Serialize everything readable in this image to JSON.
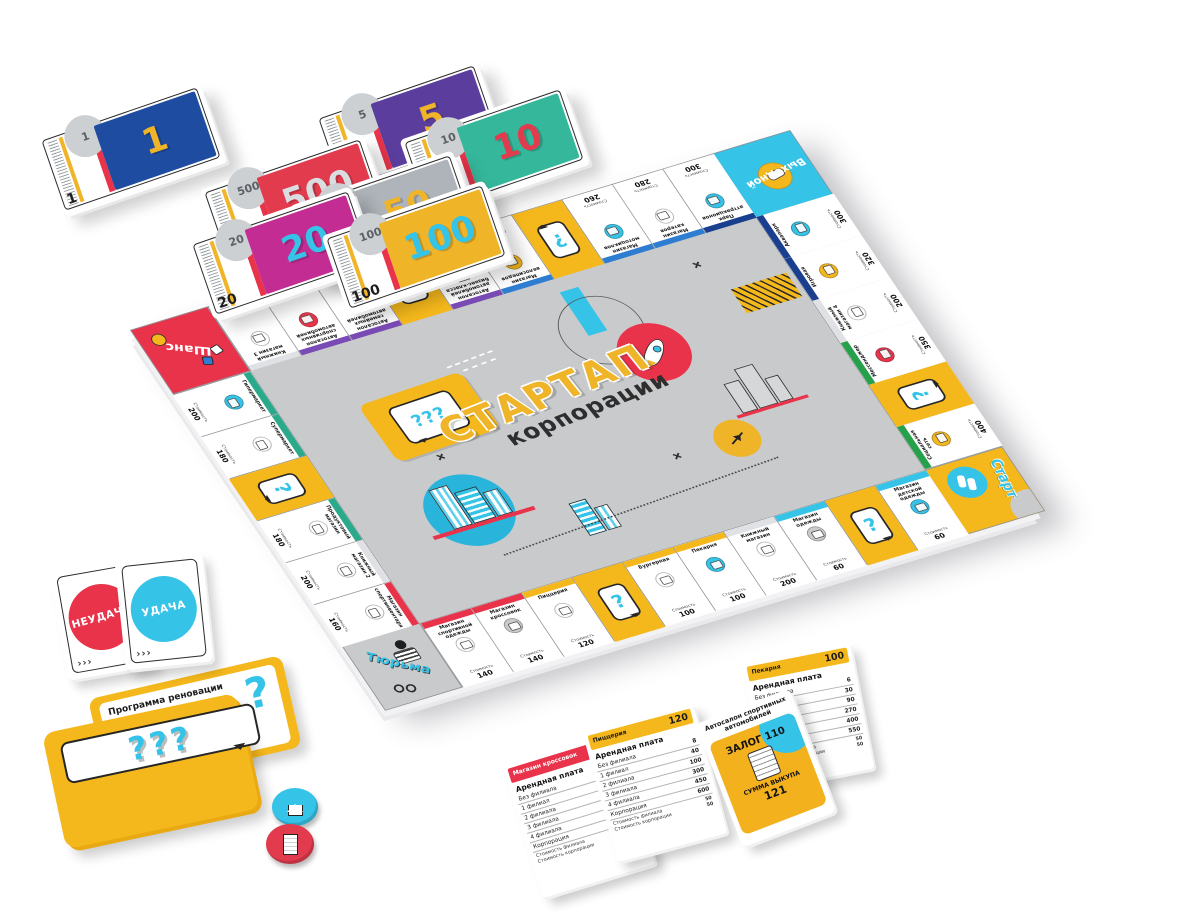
{
  "center": {
    "title_top": "СТАРТАП",
    "title_bottom": "корпорации"
  },
  "cost_label": "Стоимость",
  "question_mark": "?",
  "deco": {
    "q3": "???",
    "chevrons": "›››"
  },
  "colors": {
    "accent_yellow": "#f5b81c",
    "accent_cyan": "#35c3e8",
    "accent_red": "#e8334a",
    "board_gray": "#c9cacc",
    "group_purple": "#7a4bb5",
    "group_blue": "#2e7dd1",
    "group_darkblue": "#1b3f8f",
    "group_green": "#27a04b",
    "group_teal": "#2aa98b"
  },
  "board": {
    "corners": {
      "chance": "Шанс",
      "dayoff": "Выходной",
      "start": "Старт",
      "jail": "Тюрьма"
    },
    "top": [
      {
        "name": "Книжный магазин 3",
        "price": "200",
        "group": "#dfe1e4",
        "icon_color": "#ffffff"
      },
      {
        "name": "Автосалон спортивных автомобилей",
        "price": "220",
        "group": "#7a4bb5",
        "icon_color": "#e8334a"
      },
      {
        "name": "Автосалон семейных автомобилей",
        "price": "220",
        "group": "#7a4bb5",
        "icon_color": "#35c3e8"
      },
      {
        "type": "question"
      },
      {
        "name": "Автосалон автомобилей бизнес-класса",
        "price": "240",
        "group": "#7a4bb5",
        "icon_color": "#c9cacc",
        "badge": "VIP"
      },
      {
        "name": "Магазин велосипедов",
        "price": "260",
        "group": "#2e7dd1",
        "icon_color": "#f5b81c"
      },
      {
        "type": "question"
      },
      {
        "name": "Магазин мотоциклов",
        "price": "260",
        "group": "#2e7dd1",
        "icon_color": "#35c3e8"
      },
      {
        "name": "Магазин катеров",
        "price": "280",
        "group": "#2e7dd1",
        "icon_color": "#ffffff"
      },
      {
        "name": "Парк аттракционов",
        "price": "300",
        "group": "#1b3f8f",
        "icon_color": "#35c3e8"
      }
    ],
    "right": [
      {
        "name": "Аквапарк",
        "price": "300",
        "group": "#1b3f8f",
        "icon_color": "#35c3e8"
      },
      {
        "name": "Игровая",
        "price": "320",
        "group": "#1b3f8f",
        "icon_color": "#f5b81c"
      },
      {
        "name": "Книжный магазин 4",
        "price": "200",
        "group": "#dfe1e4",
        "icon_color": "#ffffff"
      },
      {
        "name": "Мессенджер",
        "price": "350",
        "group": "#27a04b",
        "icon_color": "#e8334a"
      },
      {
        "type": "question"
      },
      {
        "name": "Социальная сеть",
        "price": "400",
        "group": "#27a04b",
        "icon_color": "#f5b81c"
      }
    ],
    "bottom": [
      {
        "name": "Магазин спортивной одежды",
        "price": "140",
        "group": "#e8334a",
        "icon_color": "#ffffff"
      },
      {
        "name": "Магазин кроссовок",
        "price": "140",
        "group": "#e8334a",
        "icon_color": "#c9cacc"
      },
      {
        "name": "Пиццерия",
        "price": "120",
        "group": "#f5b81c",
        "icon_color": "#ffffff"
      },
      {
        "type": "question"
      },
      {
        "name": "Бургерная",
        "price": "100",
        "group": "#f5b81c",
        "icon_color": "#ffffff"
      },
      {
        "name": "Пекарня",
        "price": "100",
        "group": "#f5b81c",
        "icon_color": "#35c3e8"
      },
      {
        "name": "Книжный магазин",
        "price": "200",
        "group": "#dfe1e4",
        "icon_color": "#ffffff"
      },
      {
        "name": "Магазин одежды",
        "price": "60",
        "group": "#35c3e8",
        "icon_color": "#c9cacc"
      },
      {
        "type": "question"
      },
      {
        "name": "Магазин детской одежды",
        "price": "60",
        "group": "#35c3e8",
        "icon_color": "#35c3e8"
      }
    ],
    "left": [
      {
        "name": "Гипермаркет",
        "price": "200",
        "group": "#2aa98b",
        "icon_color": "#35c3e8"
      },
      {
        "name": "Супермаркет",
        "price": "180",
        "group": "#2aa98b",
        "icon_color": "#ffffff"
      },
      {
        "type": "question"
      },
      {
        "name": "Продуктовый магазин",
        "price": "180",
        "group": "#2aa98b",
        "icon_color": "#ffffff"
      },
      {
        "name": "Книжный магазин 2",
        "price": "200",
        "group": "#dfe1e4",
        "icon_color": "#ffffff"
      },
      {
        "name": "Магазин спортинвентаря",
        "price": "160",
        "group": "#e8334a",
        "icon_color": "#ffffff"
      }
    ]
  },
  "money": [
    {
      "value": "1",
      "color": "#1e4ca0",
      "num_color": "#f0b429"
    },
    {
      "value": "5",
      "color": "#5b3d9e",
      "num_color": "#f0b429"
    },
    {
      "value": "10",
      "color": "#35b79b",
      "num_color": "#e23b4e"
    },
    {
      "value": "20",
      "color": "#c22c93",
      "num_color": "#35c3e8"
    },
    {
      "value": "50",
      "color": "#aeb4b9",
      "num_color": "#f0b429"
    },
    {
      "value": "100",
      "color": "#f0b429",
      "num_color": "#35c3e8"
    },
    {
      "value": "500",
      "color": "#e23b4e",
      "num_color": "#d9dde0"
    }
  ],
  "cards": {
    "fail_label": "НЕУДАЧА",
    "luck_label": "УДАЧА",
    "fail_color": "#e8334a",
    "luck_color": "#35c3e8",
    "renovation_title": "Программа реновации",
    "rent_label": "Арендная плата",
    "property_cards": [
      {
        "name": "Магазин кроссовок",
        "price": "140",
        "header_color": "#e8334a",
        "header_text": "#ffffff",
        "rows": [
          [
            "Без филиала",
            "10"
          ],
          [
            "1 филиал",
            "50"
          ],
          [
            "2 филиала",
            "150"
          ],
          [
            "3 филиала",
            "450"
          ],
          [
            "4 филиала",
            "625"
          ],
          [
            "Корпорация",
            "750"
          ]
        ],
        "branch_cost_label": "Стоимость филиала",
        "branch_cost": "100",
        "corp_cost_label": "Стоимость корпорации",
        "corp_cost": "100"
      },
      {
        "name": "Пиццерия",
        "price": "120",
        "header_color": "#f5b81c",
        "header_text": "#1c1c1c",
        "rows": [
          [
            "Без филиала",
            "8"
          ],
          [
            "1 филиал",
            "40"
          ],
          [
            "2 филиала",
            "100"
          ],
          [
            "3 филиала",
            "300"
          ],
          [
            "4 филиала",
            "450"
          ],
          [
            "Корпорация",
            "600"
          ]
        ],
        "branch_cost_label": "Стоимость филиала",
        "branch_cost": "50",
        "corp_cost_label": "Стоимость корпорации",
        "corp_cost": "50"
      },
      {
        "name": "Пекарня",
        "price": "100",
        "header_color": "#f5b81c",
        "header_text": "#1c1c1c",
        "rows": [
          [
            "Без филиала",
            "6"
          ],
          [
            "1 филиал",
            "30"
          ],
          [
            "2 филиала",
            "90"
          ],
          [
            "3 филиала",
            "270"
          ],
          [
            "4 филиала",
            "400"
          ],
          [
            "Корпорация",
            "550"
          ]
        ],
        "branch_cost_label": "Стоимость филиала",
        "branch_cost": "50",
        "corp_cost_label": "Стоимость корпорации",
        "corp_cost": "50"
      }
    ],
    "mortgage_card": {
      "name": "Автосалон спортивных автомобилей",
      "pledge_label": "ЗАЛОГ",
      "pledge_value": "110",
      "ransom_label": "СУММА ВЫКУПА",
      "ransom_value": "121"
    }
  },
  "tokens": {
    "branch_color": "#35c3e8",
    "corporation_color": "#e23b4e"
  }
}
